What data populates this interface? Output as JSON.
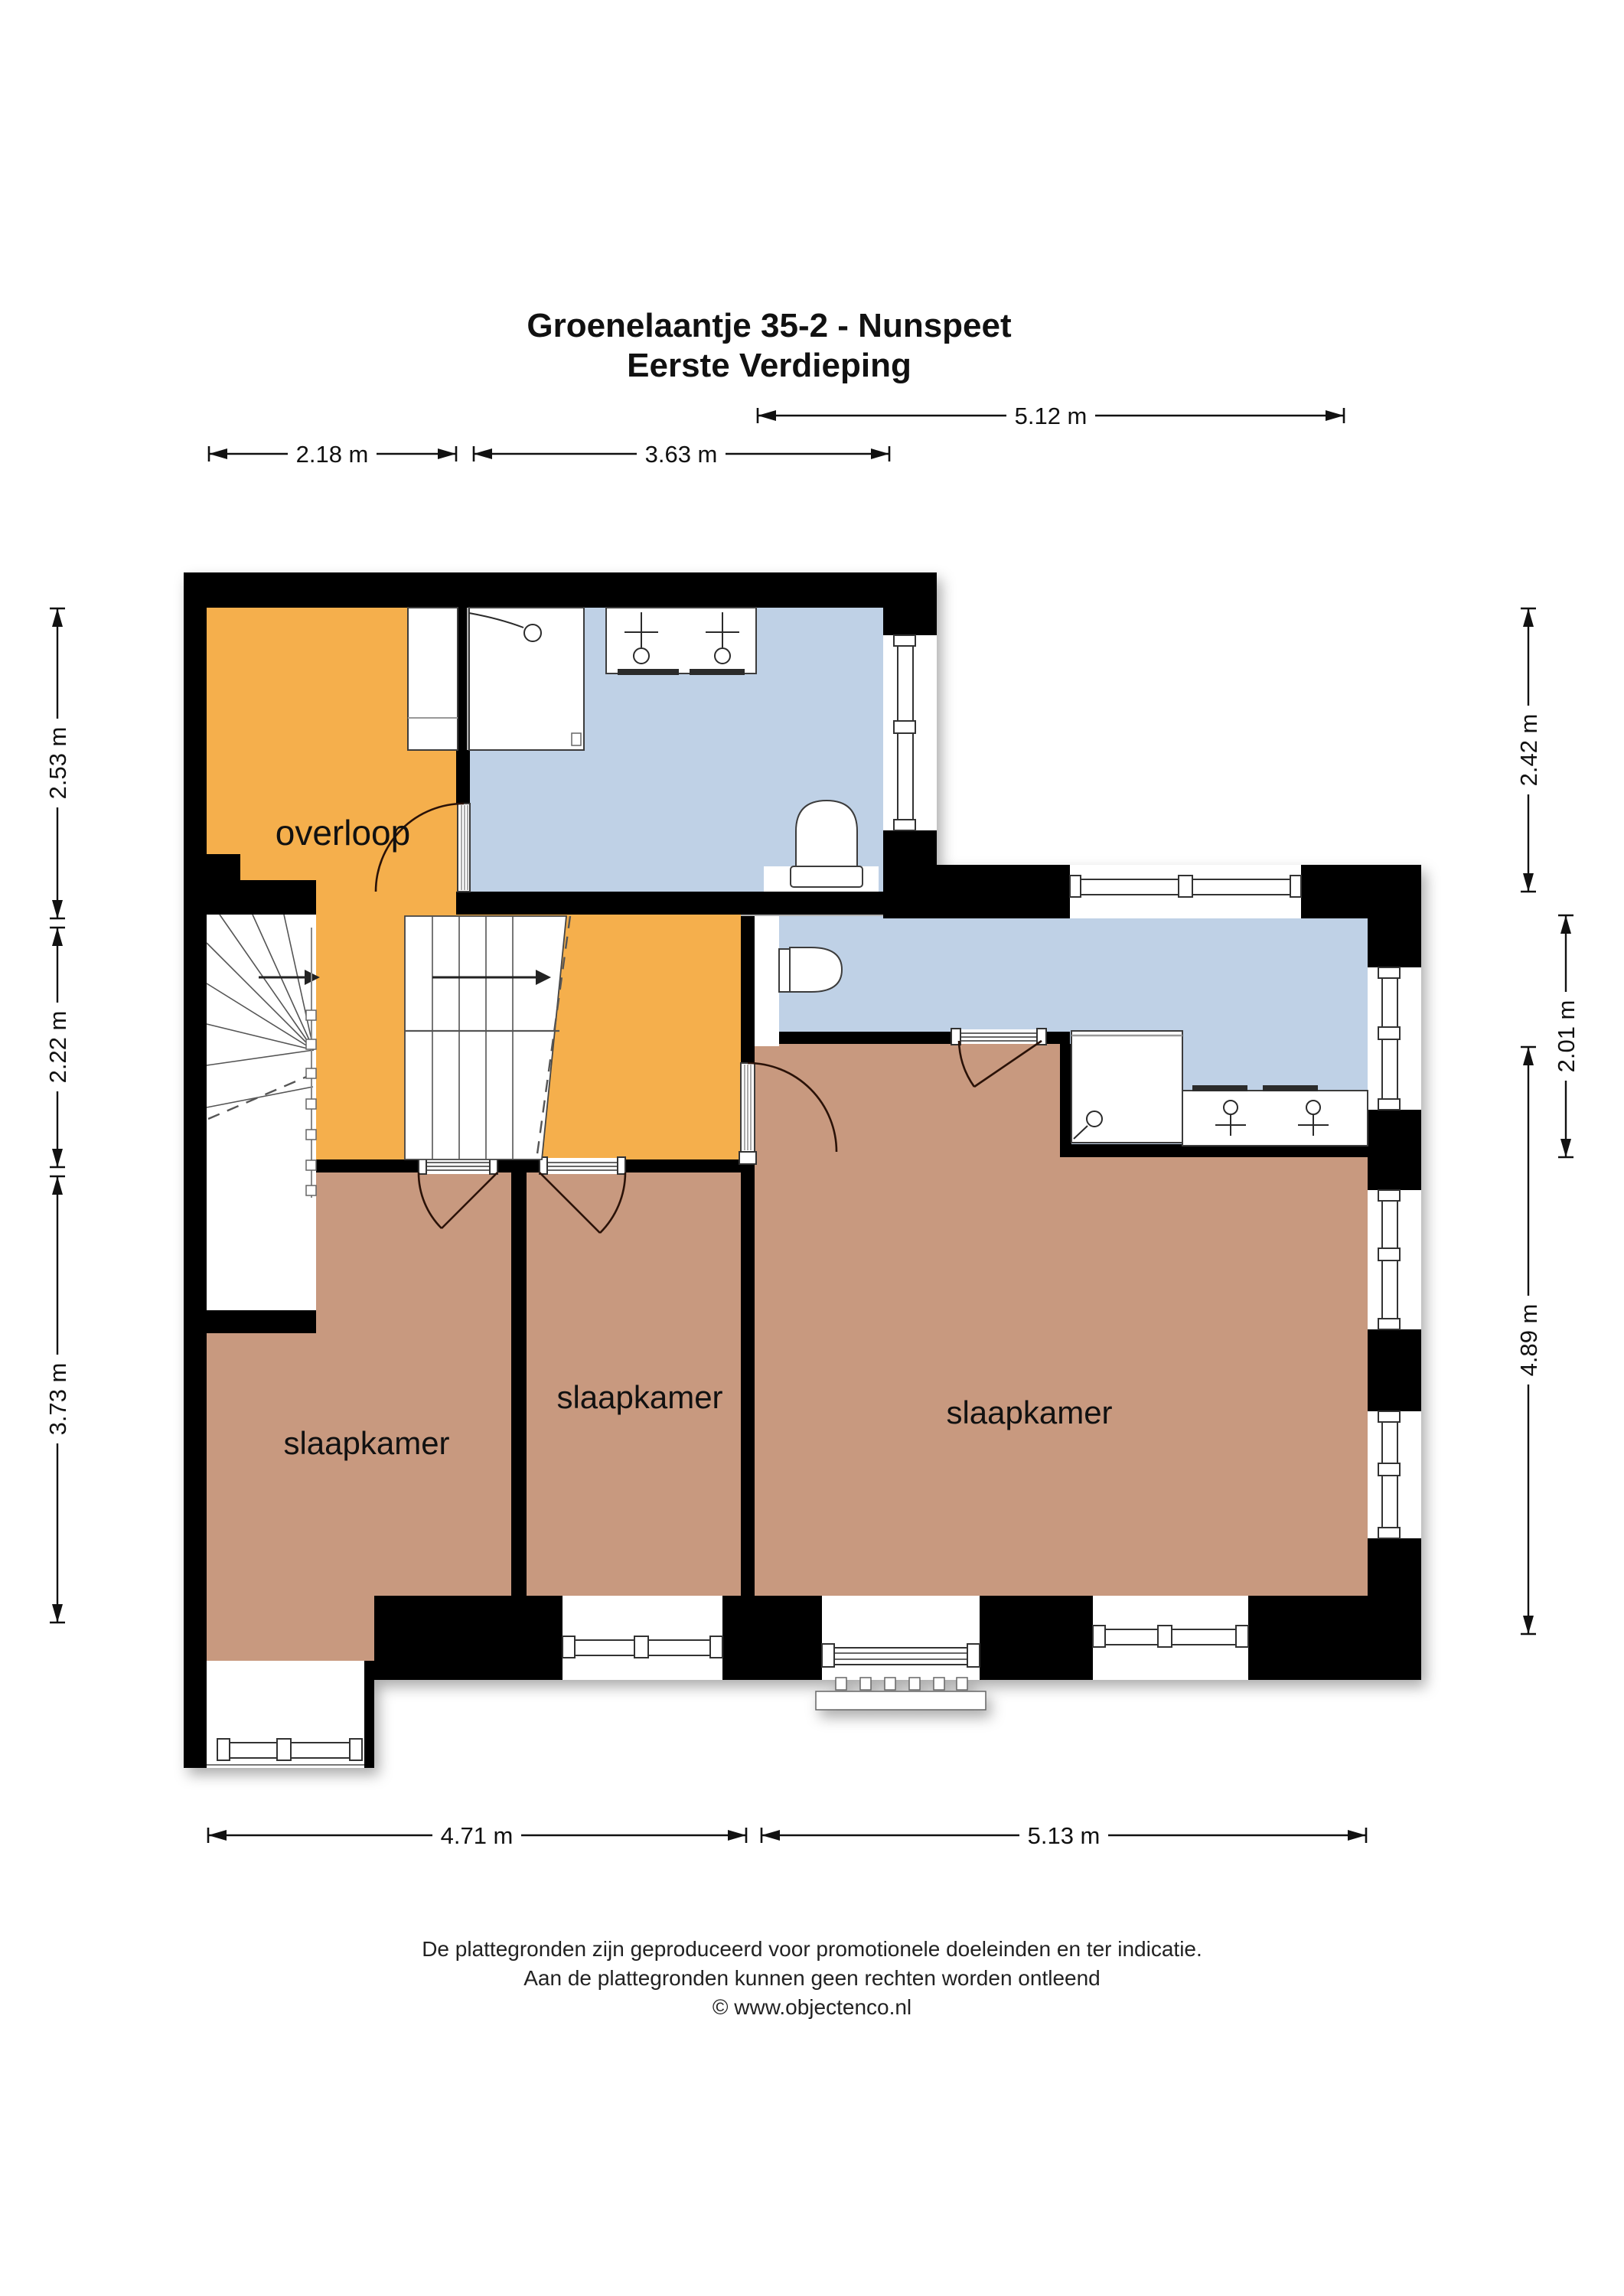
{
  "title": {
    "line1": "Groenelaantje 35-2 - Nunspeet",
    "line2": "Eerste Verdieping"
  },
  "rooms": {
    "overloop": "overloop",
    "bedroom_left": "slaapkamer",
    "bedroom_middle": "slaapkamer",
    "bedroom_right": "slaapkamer"
  },
  "dims": {
    "top_width": "5.12 m",
    "overloop_width": "2.18 m",
    "bath_width": "3.63 m",
    "left_top": "2.53 m",
    "left_mid": "2.22 m",
    "left_bottom": "3.73 m",
    "right_top": "2.42 m",
    "right_mid": "2.01 m",
    "right_bottom": "4.89 m",
    "bottom_left": "4.71 m",
    "bottom_right": "5.13 m"
  },
  "footer": {
    "line1": "De plattegronden zijn geproduceerd voor promotionele doeleinden en ter indicatie.",
    "line2": "Aan de plattegronden kunnen geen rechten worden ontleend",
    "line3": "© www.objectenco.nl"
  },
  "colors": {
    "wall": "#000000",
    "hall": "#F5AF4C",
    "bath": "#BFD1E6",
    "bed": "#C8997F"
  }
}
